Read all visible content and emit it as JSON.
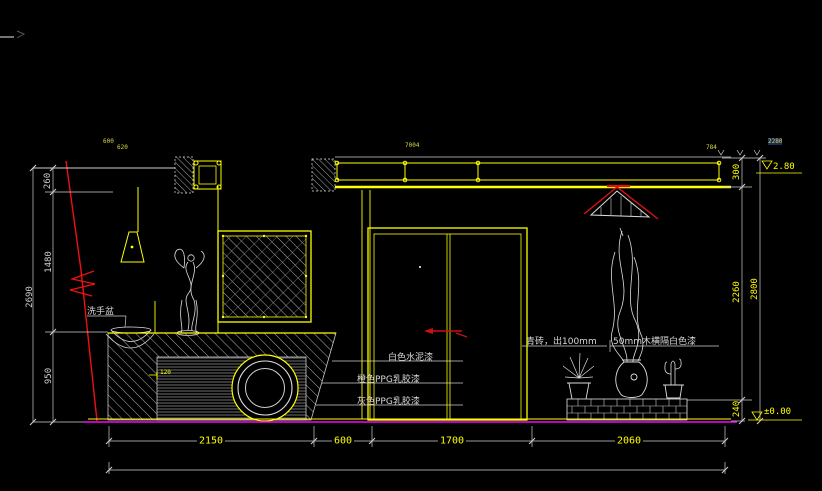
{
  "window": {
    "background": "#000000",
    "kind": "CAD elevation drawing viewport"
  },
  "drawing": {
    "labels": {
      "basin": "洗手盆",
      "paint_white": "白色水泥漆",
      "paint_orange": "橙色PPG乳胶漆",
      "paint_gray": "灰色PPG乳胶漆",
      "brick": "青砖，出100mm",
      "wood_trim": "50mm木横隔白色漆",
      "counter_detail": "120"
    },
    "dimensions": {
      "left": {
        "top": "260",
        "middle": "1480",
        "bottom": "950",
        "overall": "2690"
      },
      "right": {
        "top": "300",
        "middle": "2260",
        "bottom": "240",
        "overall": "2800"
      },
      "bottom": {
        "seg1": "2150",
        "seg2": "600",
        "seg3": "1700",
        "seg4": "2060"
      },
      "top_small": {
        "a": "600",
        "b": "620",
        "c": "7004",
        "d": "784",
        "e": "2280"
      }
    },
    "elevation_markers": {
      "top": "2.80",
      "bottom": "±0.00"
    },
    "colors": {
      "line_primary": "#ffff00",
      "line_secondary": "#cfcfcf",
      "accent_red": "#ee1111",
      "floor_magenta": "#ff00ff",
      "background": "#000000"
    }
  }
}
